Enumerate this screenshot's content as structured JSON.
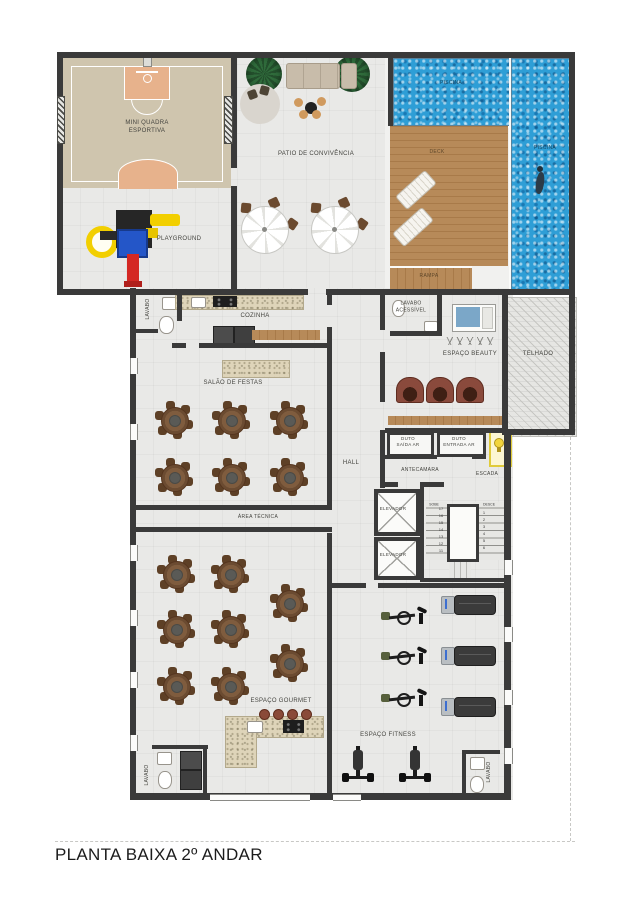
{
  "title": "PLANTA BAIXA 2º ANDAR",
  "rooms": {
    "quadra": {
      "label": "MINI QUADRA\nESPORTIVA"
    },
    "playground": {
      "label": "PLAYGROUND"
    },
    "patio": {
      "label": "PATIO DE CONVIVÊNCIA"
    },
    "piscina_top": {
      "label": "PISCINA"
    },
    "piscina_right": {
      "label": "PISCINA"
    },
    "deck": {
      "label": "DECK"
    },
    "rampa": {
      "label": "RAMPA"
    },
    "lavabo_cozinha": {
      "label": "LAVABO"
    },
    "cozinha": {
      "label": "COZINHA"
    },
    "salao_festas": {
      "label": "SALÃO DE FESTAS"
    },
    "hall": {
      "label": "HALL"
    },
    "lavabo_acessivel": {
      "label": "LAVABO\nACESSÍVEL"
    },
    "espaco_beauty": {
      "label": "ESPAÇO BEAUTY"
    },
    "telhado": {
      "label": "TELHADO"
    },
    "duto_saida": {
      "label": "DUTO\nSAÍDA AR"
    },
    "duto_entrada": {
      "label": "DUTO\nENTRADA AR"
    },
    "antecamara": {
      "label": "ANTECAMARA"
    },
    "escada": {
      "label": "ESCADA"
    },
    "elevador_1": {
      "label": "ELEVADOR"
    },
    "elevador_2": {
      "label": "ELEVADOR"
    },
    "area_tecnica": {
      "label": "ÁREA TÉCNICA"
    },
    "espaco_gourmet": {
      "label": "ESPAÇO GOURMET"
    },
    "espaco_fitness": {
      "label": "ESPAÇO FITNESS"
    },
    "lavabo_gourmet": {
      "label": "LAVABO"
    },
    "lavabo_fitness": {
      "label": "LAVABO"
    }
  },
  "stairs": {
    "up_label": "SOBE",
    "down_label": "DESCE",
    "up_numbers": [
      "17",
      "16",
      "15",
      "14",
      "13",
      "12",
      "11"
    ],
    "down_numbers": [
      "1",
      "2",
      "3",
      "4",
      "5",
      "6"
    ]
  },
  "colors": {
    "wall": "#3a3a3a",
    "floor": "#e9e9e7",
    "court": "#cfc5ae",
    "court_accent": "#e7b28c",
    "pool": "#2e9ed6",
    "deck_wood": "#b78a59",
    "granite": "#ded4b9",
    "table_brown": "#6b4b31",
    "emergency_yellow": "#f2d53c"
  }
}
